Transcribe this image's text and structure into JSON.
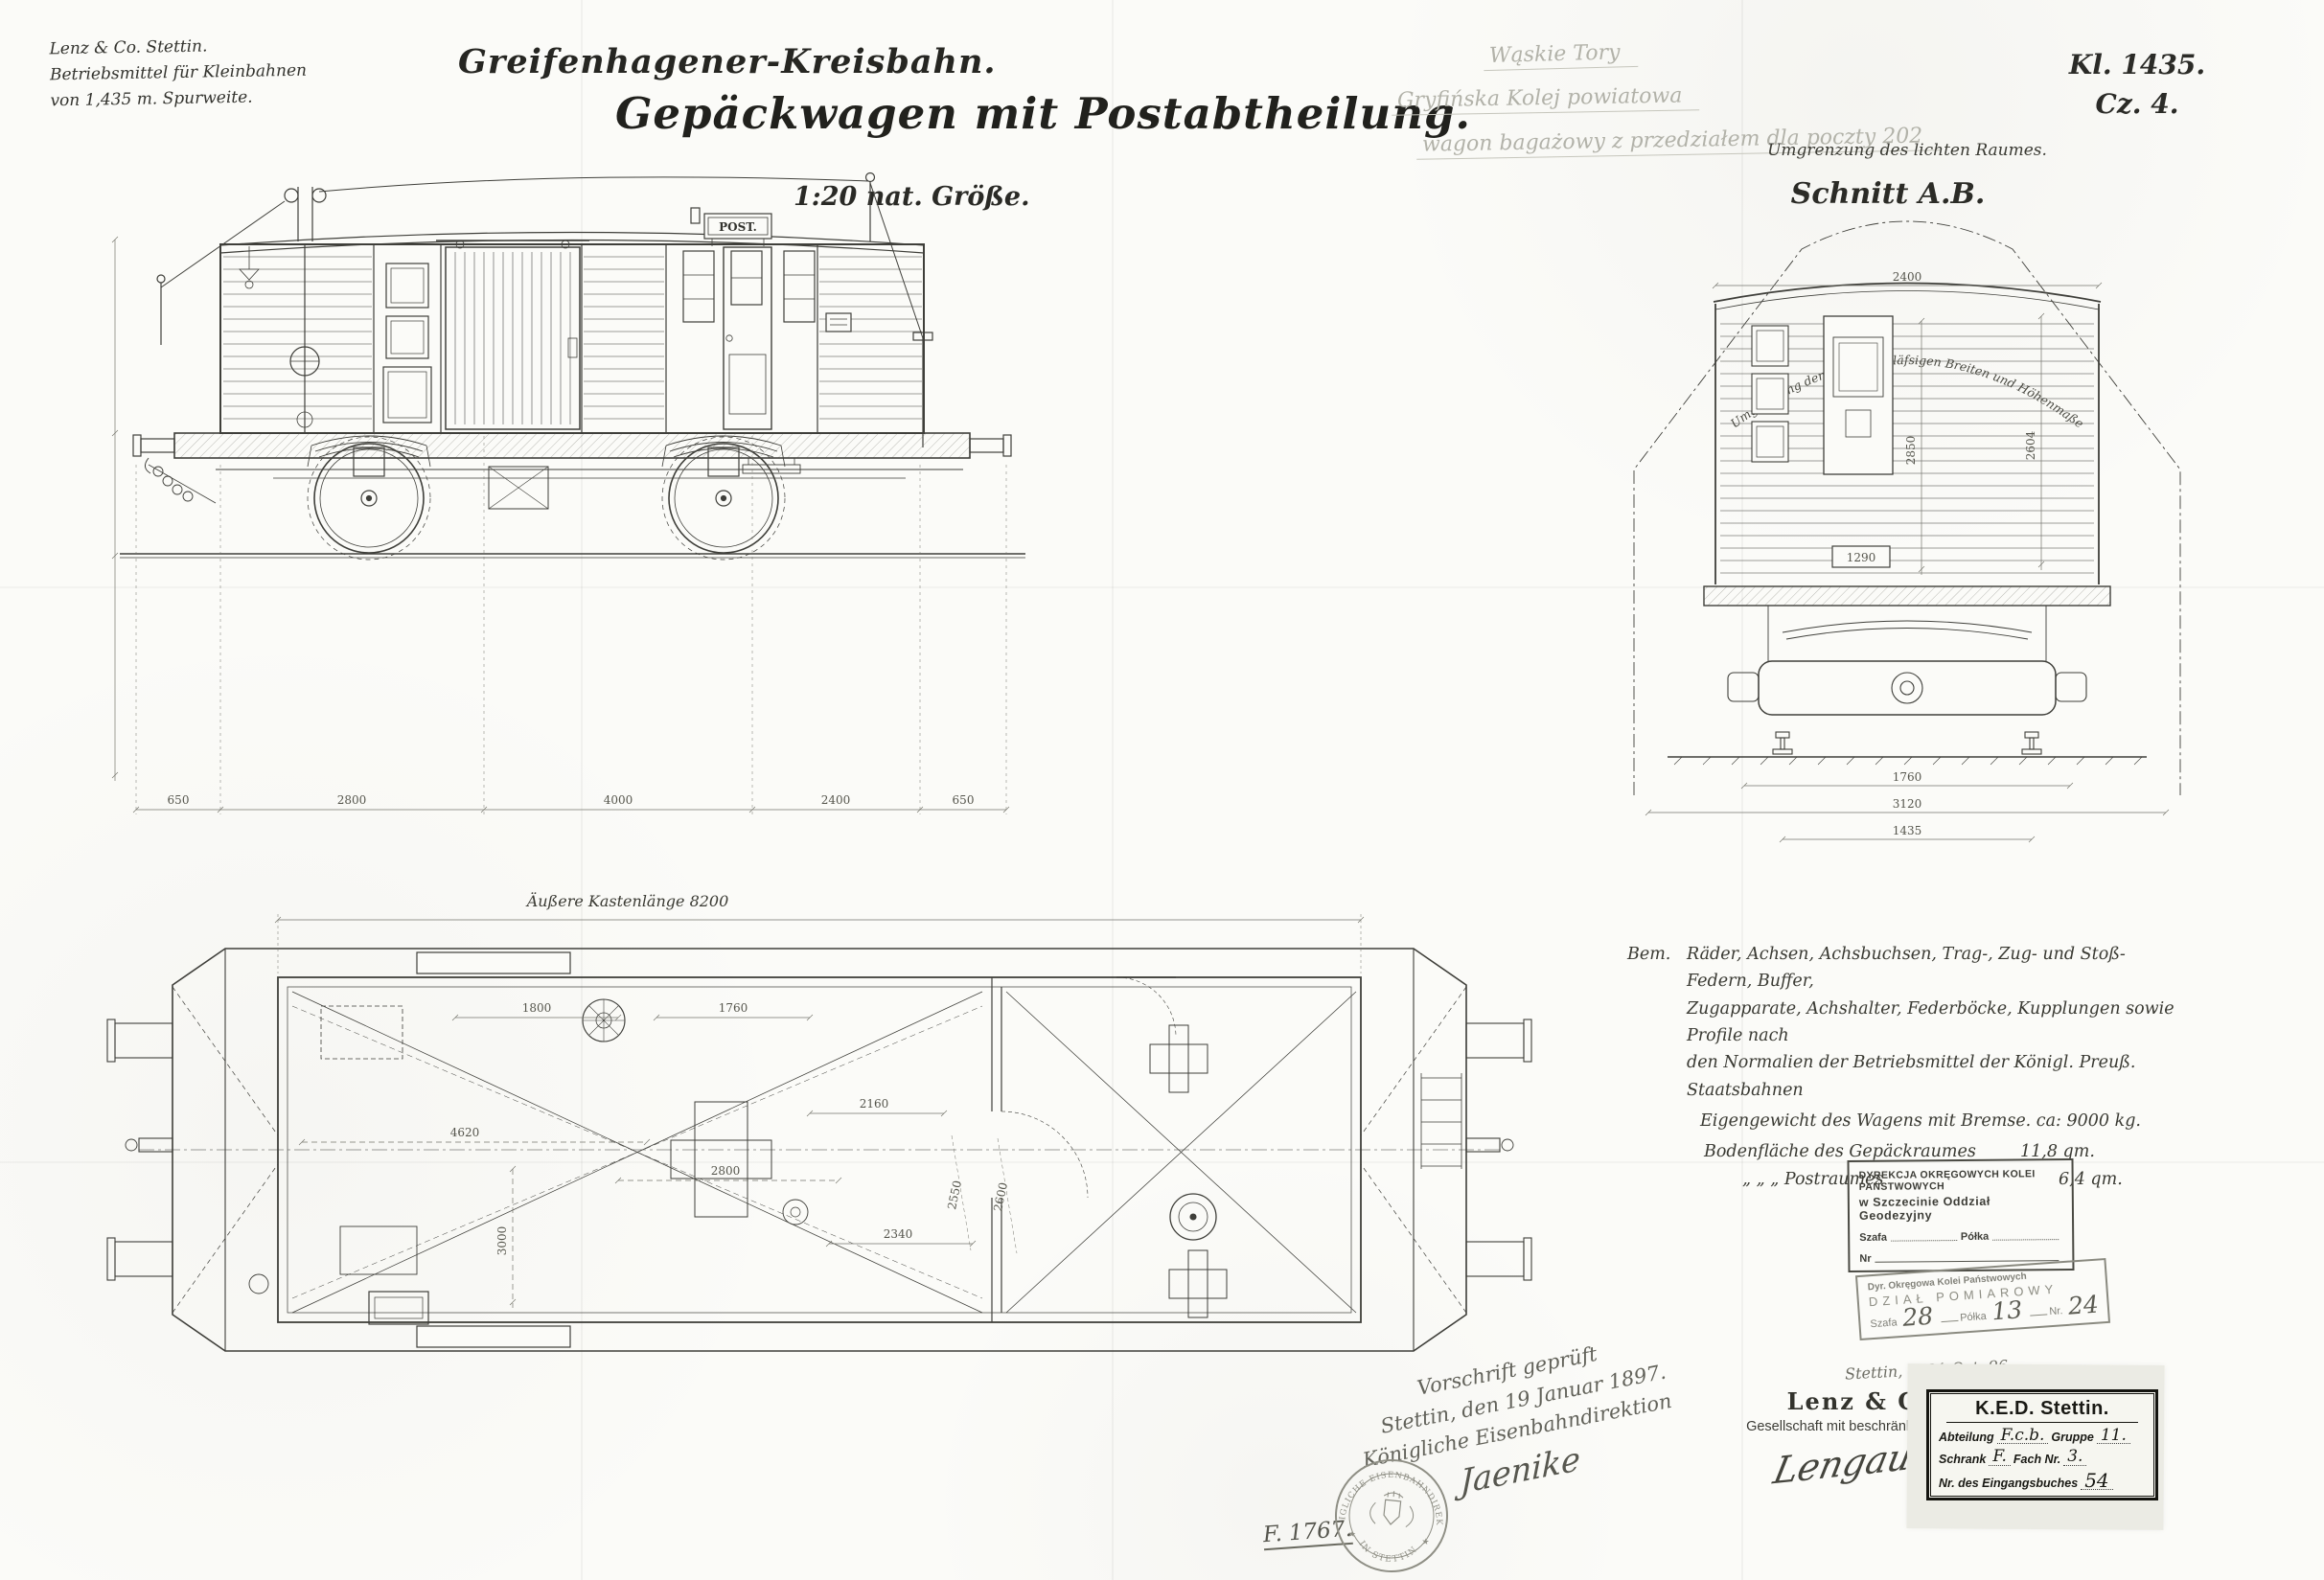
{
  "header": {
    "company_line1": "Lenz & Co. Stettin.",
    "company_line2": "Betriebsmittel für Kleinbahnen",
    "company_line3": "von 1,435 m. Spurweite.",
    "railway": "Greifenhagener-Kreisbahn.",
    "title": "Gepäckwagen mit Postabtheilung.",
    "scale": "1:20 nat. Größe.",
    "code_line1": "Kl. 1435.",
    "code_line2": "Cz. 4."
  },
  "pencil": {
    "line1": "Wąskie Tory",
    "line2": "Gryfińska Kolej powiatowa",
    "line3": "wagon bagażowy z przedziałem dla poczty 202"
  },
  "cross_section": {
    "clearance_note": "Umgrenzung des lichten Raumes.",
    "label": "Schnitt A.B.",
    "arc_note": "Umgrenzung der größten zuläfsigen Breiten und Höhenmaße",
    "dims": {
      "width_top": "2400",
      "interior": "2604",
      "door": "2850",
      "floor": "1290",
      "axle": "3120",
      "wheelbase": "1760",
      "gauge": "1435"
    }
  },
  "side_view": {
    "post_sign": "POST.",
    "dims_bottom": {
      "s1": "650",
      "s2": "2800",
      "s3": "4000",
      "s4": "2400",
      "s5": "650"
    }
  },
  "plan_view": {
    "length_label": "Äußere Kastenlänge 8200",
    "dims": {
      "d1": "1800",
      "d2": "1760",
      "d3": "4620",
      "d4": "2800",
      "d5": "3000",
      "d6": "2340",
      "d7": "2160",
      "d8": "2550",
      "d9": "2600"
    }
  },
  "notes": {
    "label": "Bem.",
    "line1": "Räder, Achsen, Achsbuchsen, Trag-, Zug- und Stoß-Federn, Buffer,",
    "line2": "Zugapparate, Achshalter, Federböcke, Kupplungen sowie Profile nach",
    "line3": "den Normalien der Betriebsmittel der Königl. Preuß. Staatsbahnen",
    "line4": "Eigengewicht des Wagens mit Bremse. ca: 9000 kg.",
    "line5_label": "Bodenfläche des Gepäckraumes",
    "line5_value": "11,8 qm.",
    "line6_label": "„    „    „   Postraumes",
    "line6_value": "6,4 qm."
  },
  "stamp_geodesy": {
    "line1": "DYREKCJA OKRĘGOWYCH KOLEI PAŃSTWOWYCH",
    "line2": "w Szczecinie Oddział Geodezyjny",
    "field1": "Szafa",
    "field2": "Półka",
    "field3": "Nr"
  },
  "stamp_survey": {
    "line1": "Dyr. Okręgowa Kolei Państwowych",
    "line2": "DZIAŁ POMIAROWY",
    "field1": "Szafa",
    "value1": "28",
    "field2": "Półka",
    "value2": "13",
    "field3": "Nr.",
    "value3": "24"
  },
  "approval": {
    "line1": "Vorschrift geprüft",
    "line2": "Stettin, den 19 Januar 1897.",
    "line3": "Königliche Eisenbahndirektion",
    "signature": "Jaenike",
    "file_no": "F. 1767."
  },
  "seal": {
    "text_top": "KÖNIGLICHE EISENBAHNDIREKTION",
    "text_bottom": "IN STETTIN"
  },
  "publisher": {
    "date_note": "Stettin, d. 21 Oct. 96.",
    "name": "Lenz & Co.",
    "subtitle": "Gesellschaft mit beschränkter Haftung.",
    "signature": "Lengauer."
  },
  "ked_box": {
    "title": "K.E.D. Stettin.",
    "row1_label1": "Abteilung",
    "row1_value1": "F.c.b.",
    "row1_label2": "Gruppe",
    "row1_value2": "11.",
    "row2_label1": "Schrank",
    "row2_value1": "F.",
    "row2_label2": "Fach Nr.",
    "row2_value2": "3.",
    "row3_label": "Nr. des Eingangsbuches",
    "row3_value": "54"
  }
}
